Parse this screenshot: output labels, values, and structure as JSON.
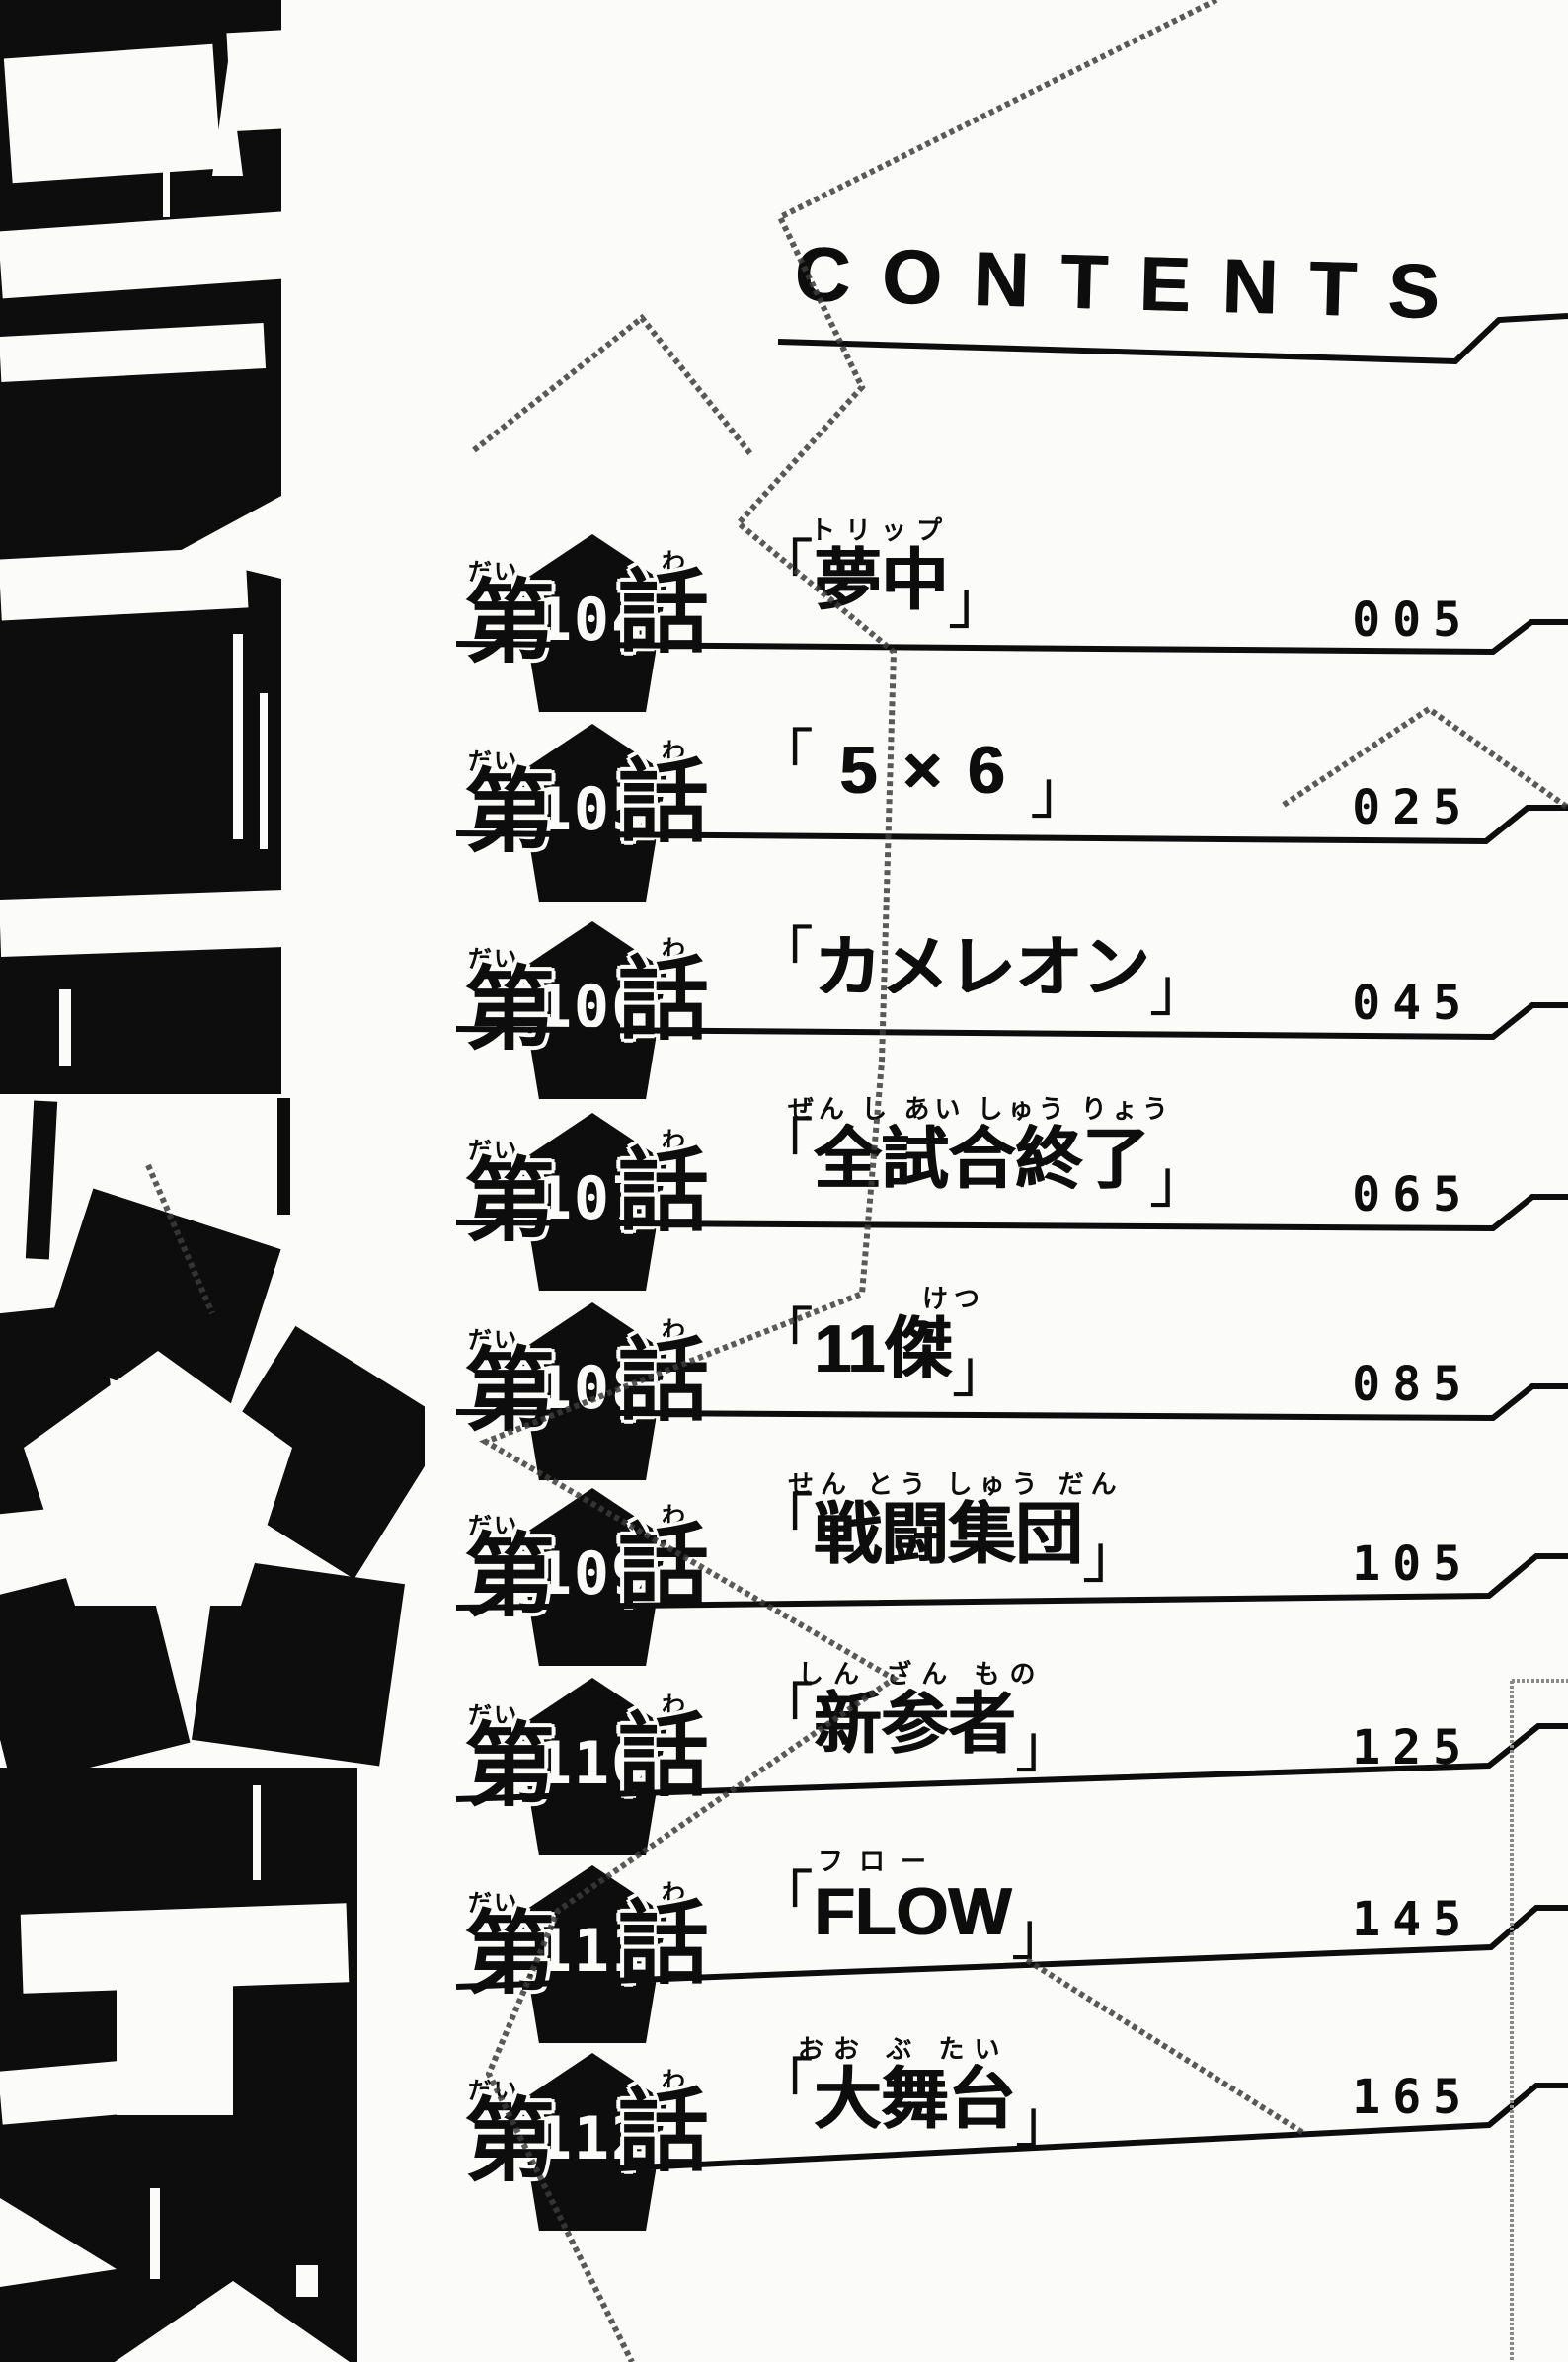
{
  "page_title": "CONTENTS",
  "labels": {
    "chapter_prefix": "第",
    "chapter_suffix": "話",
    "prefix_reading": "だい",
    "suffix_reading": "わ",
    "open_quote": "「",
    "close_quote": "」"
  },
  "chapters": [
    {
      "number": "104",
      "reading": "トリップ",
      "title": "夢中",
      "page": "005"
    },
    {
      "number": "105",
      "reading": "",
      "title": "5×6",
      "page": "025"
    },
    {
      "number": "106",
      "reading": "",
      "title": "カメレオン",
      "page": "045"
    },
    {
      "number": "107",
      "reading": "ぜん し あい しゅう りょう",
      "title": "全試合終了",
      "page": "065"
    },
    {
      "number": "108",
      "reading": "けつ",
      "title": "11傑",
      "page": "085"
    },
    {
      "number": "109",
      "reading": "せん とう しゅう だん",
      "title": "戦闘集団",
      "page": "105"
    },
    {
      "number": "110",
      "reading": "しん ざん もの",
      "title": "新参者",
      "page": "125"
    },
    {
      "number": "111",
      "reading": "フロー",
      "title": "FLOW",
      "page": "145"
    },
    {
      "number": "112",
      "reading": "おお ぶ たい",
      "title": "大舞台",
      "page": "165"
    }
  ],
  "colors": {
    "ink": "#0d0d0d",
    "paper": "#fbfbfa"
  }
}
